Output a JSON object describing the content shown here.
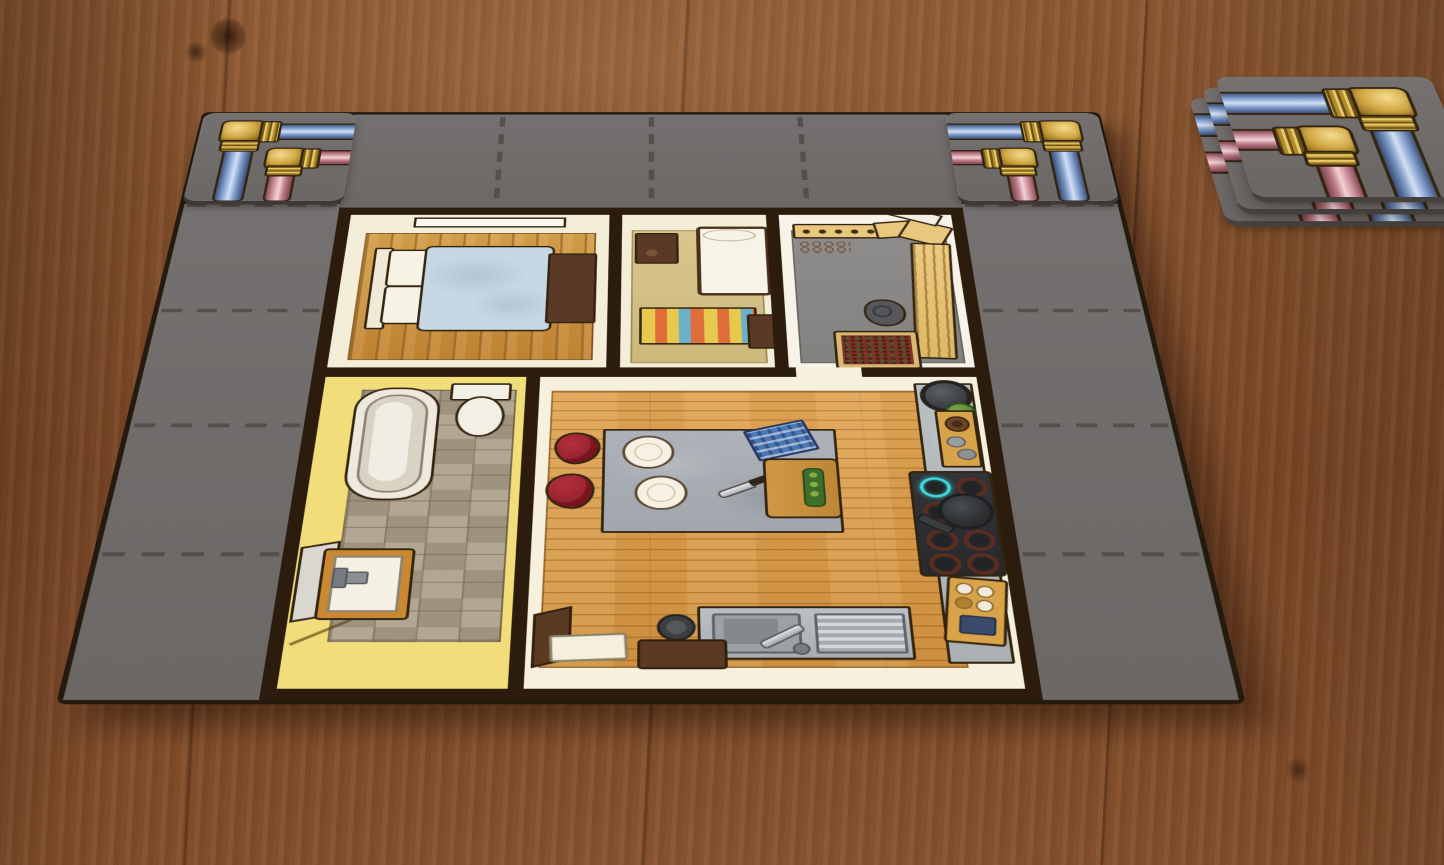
{
  "scene": {
    "type": "digital-board-game-tabletop",
    "surface": "wooden-table",
    "visible_text": ""
  },
  "palette": {
    "wood": "#7c4a28",
    "tile_gray": "#6b6866",
    "tile_gray_light": "#747170",
    "dash": "#4e4b49",
    "wall": "#2c1c0d",
    "outline": "#33240f",
    "cream_wall": "#f4edd8",
    "white_wall": "#f7f3e8",
    "yellow_wall": "#f1dd7a",
    "bedroom_floor": "#c98f3c",
    "kitchen_floor": "#d59947",
    "kids_floor": "#d3c085",
    "hall_floor": "#8b8987",
    "bath_tile": "#a39884",
    "pipe_blue": "#7c98c6",
    "pipe_pink": "#cf96a0",
    "brass": "#d2a946",
    "duvet_blue": "#c5d8e3",
    "rug_gray": "#a9aeb4",
    "chair_red": "#a32834",
    "rug_yellow": "#e7c94e",
    "rug_orange": "#df6f3a",
    "rug_blue": "#6fb0c9",
    "counter_gray": "#b6babd",
    "stove_black": "#2f3133",
    "flame_teal": "#3fd8de",
    "furniture_brown": "#5a3a26",
    "cabinet_tan": "#e8c77e",
    "sink_frame_orange": "#cb8832"
  },
  "board": {
    "grid_cols": 6,
    "grid_rows": 5,
    "border_cells": {
      "top_row": 4,
      "left_column": 4,
      "right_column": 4
    },
    "dashed_separators": true,
    "corner_pipe_tiles": [
      {
        "position": "top-left",
        "pipes": [
          {
            "color": "blue",
            "route": "right-edge-to-bottom-elbow"
          },
          {
            "color": "pink",
            "route": "right-edge-to-bottom-elbow"
          }
        ]
      },
      {
        "position": "top-right",
        "pipes": [
          {
            "color": "blue",
            "route": "left-edge-to-bottom-elbow"
          },
          {
            "color": "pink",
            "route": "left-edge-to-bottom-elbow"
          }
        ]
      }
    ]
  },
  "draw_pile": {
    "tile_count": 3,
    "top_tile_pipes": [
      {
        "color": "blue",
        "route": "left-edge-to-bottom-elbow"
      },
      {
        "color": "pink",
        "route": "left-edge-to-bottom-elbow"
      }
    ]
  },
  "house": {
    "rooms": [
      {
        "name": "bedroom",
        "floor": "wood-planks",
        "furniture": [
          "window",
          "headboard",
          "pillow",
          "pillow",
          "blue-duvet-bed",
          "foot-chest"
        ],
        "pillow_count": 2
      },
      {
        "name": "kids-room",
        "floor": "tan",
        "furniture": [
          "dresser",
          "single-bed",
          "striped-rug",
          "stool"
        ],
        "rug_stripe_colors": [
          "yellow",
          "orange",
          "blue"
        ]
      },
      {
        "name": "hallway",
        "floor": "gray",
        "furniture": [
          "shoe-shelf",
          "shoe-marks",
          "box",
          "box",
          "wardrobe",
          "bag",
          "doormat",
          "front-door"
        ],
        "shoe_count": 5,
        "box_count": 2
      },
      {
        "name": "bathroom",
        "floor": "tiles",
        "furniture": [
          "bathtub",
          "toilet",
          "sink",
          "open-door"
        ]
      },
      {
        "name": "kitchen-living",
        "floor": "wood-planks",
        "furniture": [
          "dining-rug",
          "plate",
          "plate",
          "checkered-cloth",
          "knife",
          "cutting-board",
          "chair",
          "chair",
          "counter",
          "pot",
          "plant",
          "veg-board",
          "cooktop",
          "frying-pan",
          "egg-tray",
          "sink-unit",
          "pet-bowl",
          "white-mat",
          "brown-mat",
          "side-mat"
        ],
        "plate_count": 2,
        "chair_count": 2,
        "burner_count": 8,
        "lit_burners": 1,
        "egg_slots": 6
      }
    ]
  }
}
